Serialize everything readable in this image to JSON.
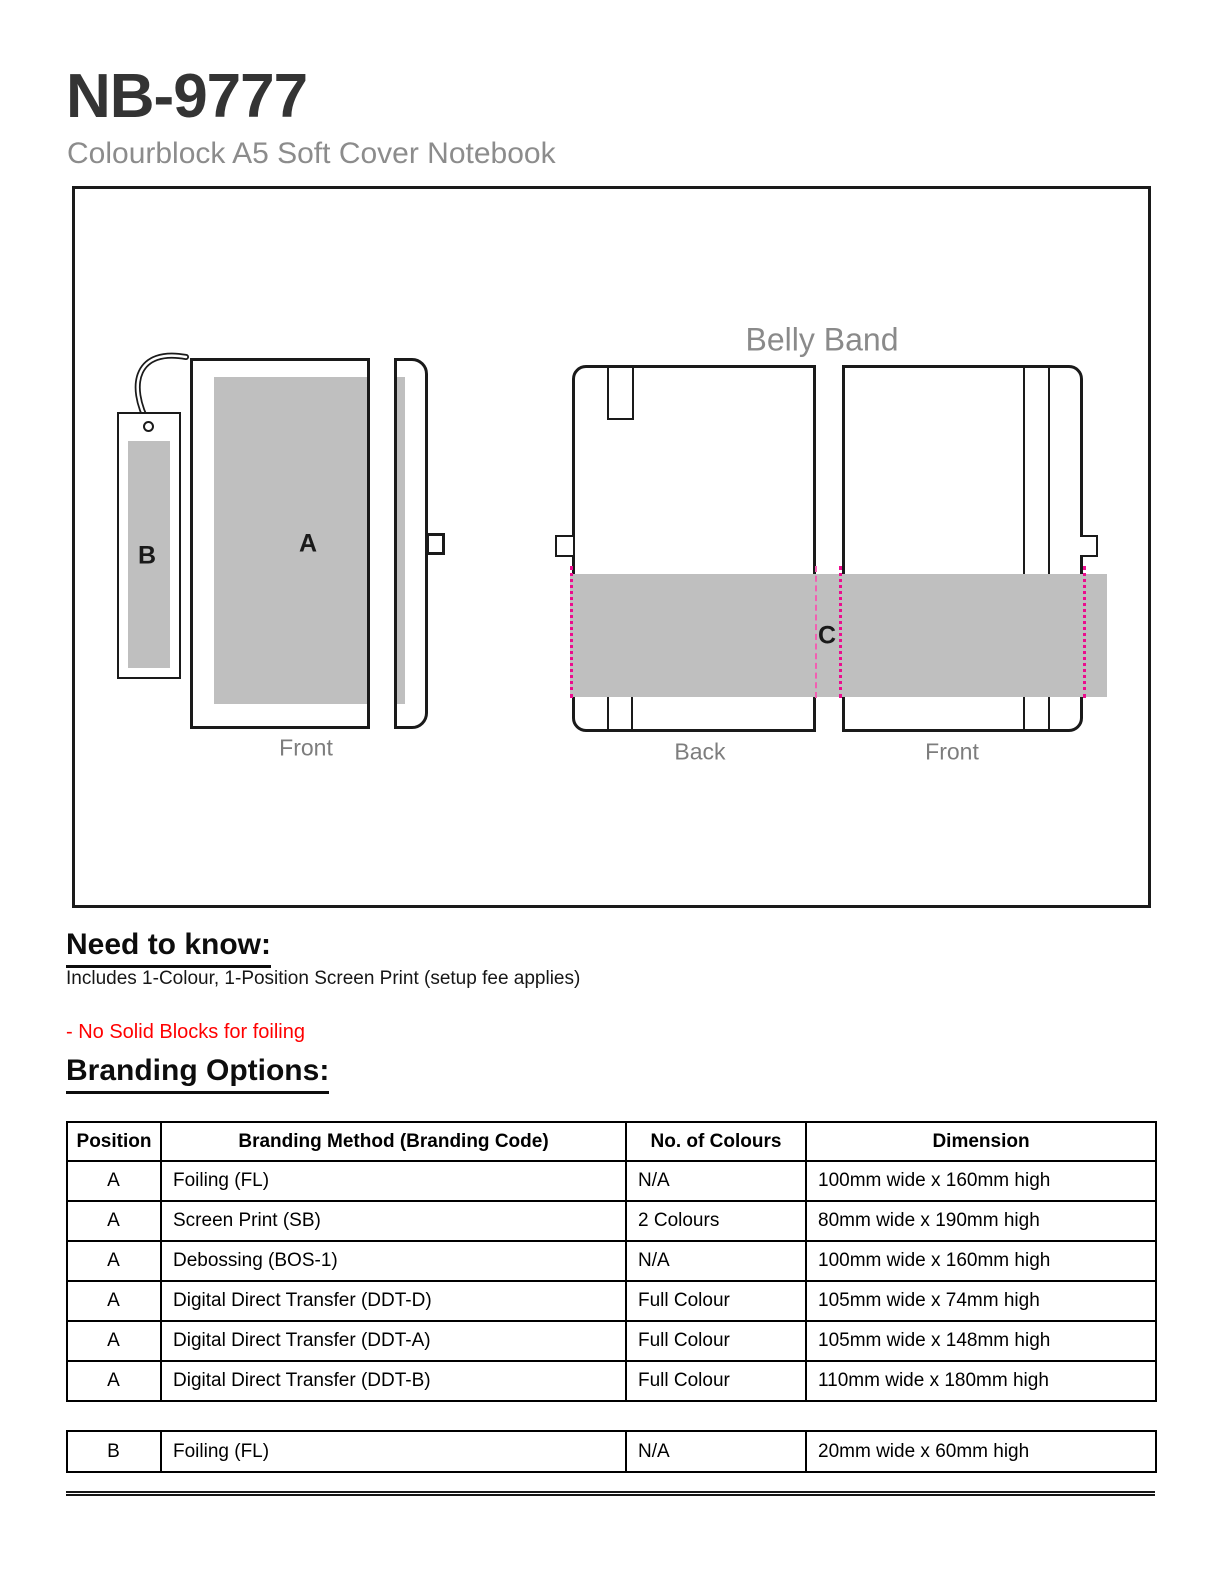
{
  "page": {
    "title": "NB-9777",
    "subtitle": "Colourblock A5 Soft Cover Notebook"
  },
  "diagram": {
    "belly_band_label": "Belly Band",
    "front_left_label": "Front",
    "back_label": "Back",
    "front_right_label": "Front",
    "position_a": "A",
    "position_b": "B",
    "position_c": "C",
    "print_area_color": "#bfbfbf",
    "guide_line_color": "#ec0c8e"
  },
  "need_to_know": {
    "heading": "Need to know:",
    "line1": "Includes 1-Colour, 1-Position Screen Print (setup fee applies)",
    "note": "- No Solid Blocks for foiling",
    "note_color": "#ff0000"
  },
  "branding_options": {
    "heading": "Branding Options:",
    "columns": [
      "Position",
      "Branding Method (Branding Code)",
      "No. of Colours",
      "Dimension"
    ],
    "rows": [
      [
        "A",
        "Foiling (FL)",
        "N/A",
        "100mm wide x 160mm high"
      ],
      [
        "A",
        "Screen Print (SB)",
        "2 Colours",
        "80mm wide x 190mm high"
      ],
      [
        "A",
        "Debossing (BOS-1)",
        "N/A",
        "100mm wide x 160mm high"
      ],
      [
        "A",
        "Digital Direct Transfer (DDT-D)",
        "Full Colour",
        "105mm wide x 74mm high"
      ],
      [
        "A",
        "Digital Direct Transfer (DDT-A)",
        "Full Colour",
        "105mm wide x 148mm high"
      ],
      [
        "A",
        "Digital Direct Transfer (DDT-B)",
        "Full Colour",
        "110mm wide x 180mm high"
      ]
    ],
    "extra_rows": [
      [
        "B",
        "Foiling (FL)",
        "N/A",
        "20mm wide x 60mm high"
      ]
    ]
  }
}
